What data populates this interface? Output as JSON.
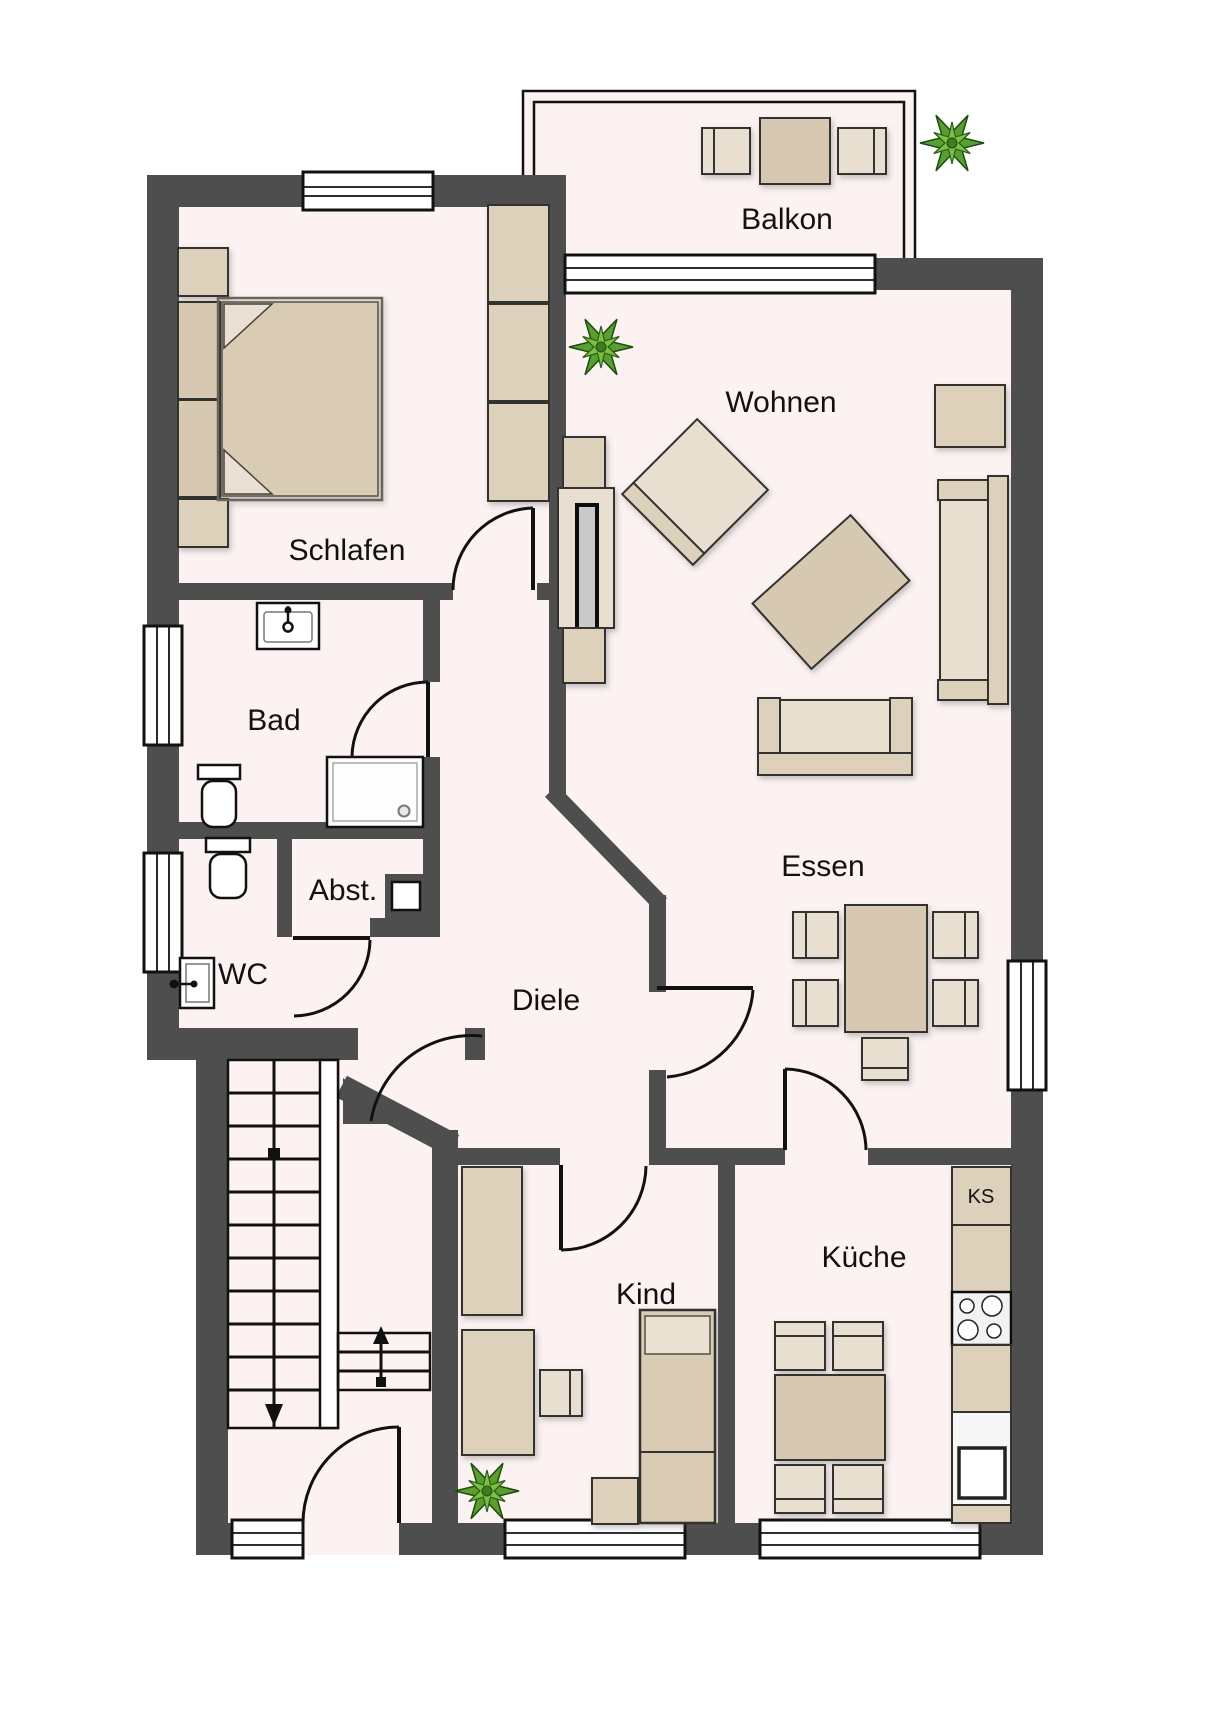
{
  "colors": {
    "wall": "#4e4e4e",
    "floor": "#fcf2f1",
    "furniture": "#ddd1bc",
    "furniture_dark": "#d7c9b1",
    "furniture_light": "#e9dfd0",
    "fixture_white": "#ffffff",
    "outline": "#111111",
    "plant_green": "#5a9e2f",
    "background": "#ffffff"
  },
  "rooms": {
    "balkon": {
      "label": "Balkon",
      "furniture": [
        "table",
        "chair",
        "chair",
        "potted-plant"
      ]
    },
    "wohnen": {
      "label": "Wohnen",
      "furniture": [
        "potted-plant",
        "tv-lowboard",
        "tv",
        "armchair",
        "coffee-table",
        "side-table",
        "sofa"
      ]
    },
    "schlafen": {
      "label": "Schlafen",
      "furniture": [
        "double-bed",
        "headboard",
        "nightstand",
        "nightstand",
        "wardrobe-3-sections"
      ]
    },
    "bad": {
      "label": "Bad",
      "furniture": [
        "washbasin",
        "toilet",
        "shower"
      ]
    },
    "abst": {
      "label": "Abst.",
      "furniture": [
        "duct-niche"
      ]
    },
    "wc": {
      "label": "WC",
      "furniture": [
        "toilet",
        "washbasin"
      ]
    },
    "diele": {
      "label": "Diele",
      "furniture": []
    },
    "essen": {
      "label": "Essen",
      "furniture": [
        "sofa",
        "dining-table",
        "chair",
        "chair",
        "chair",
        "chair",
        "chair"
      ]
    },
    "kind": {
      "label": "Kind",
      "furniture": [
        "wardrobe",
        "desk",
        "desk-chair",
        "potted-plant",
        "bed",
        "nightstand"
      ]
    },
    "kueche": {
      "label": "Küche",
      "ks_label": "KS",
      "furniture": [
        "fridge-KS",
        "counter",
        "stove-4-burners",
        "counter",
        "sink",
        "kitchen-table",
        "chair",
        "chair",
        "chair",
        "chair"
      ]
    }
  },
  "stairs": {
    "main_flight_direction": "down",
    "landing_steps": 3,
    "landing_direction": "up"
  },
  "doors": [
    "schlafen",
    "bad",
    "wc",
    "essen",
    "kind",
    "kueche",
    "apartment-entry",
    "building-entry"
  ],
  "windows_count": 8
}
